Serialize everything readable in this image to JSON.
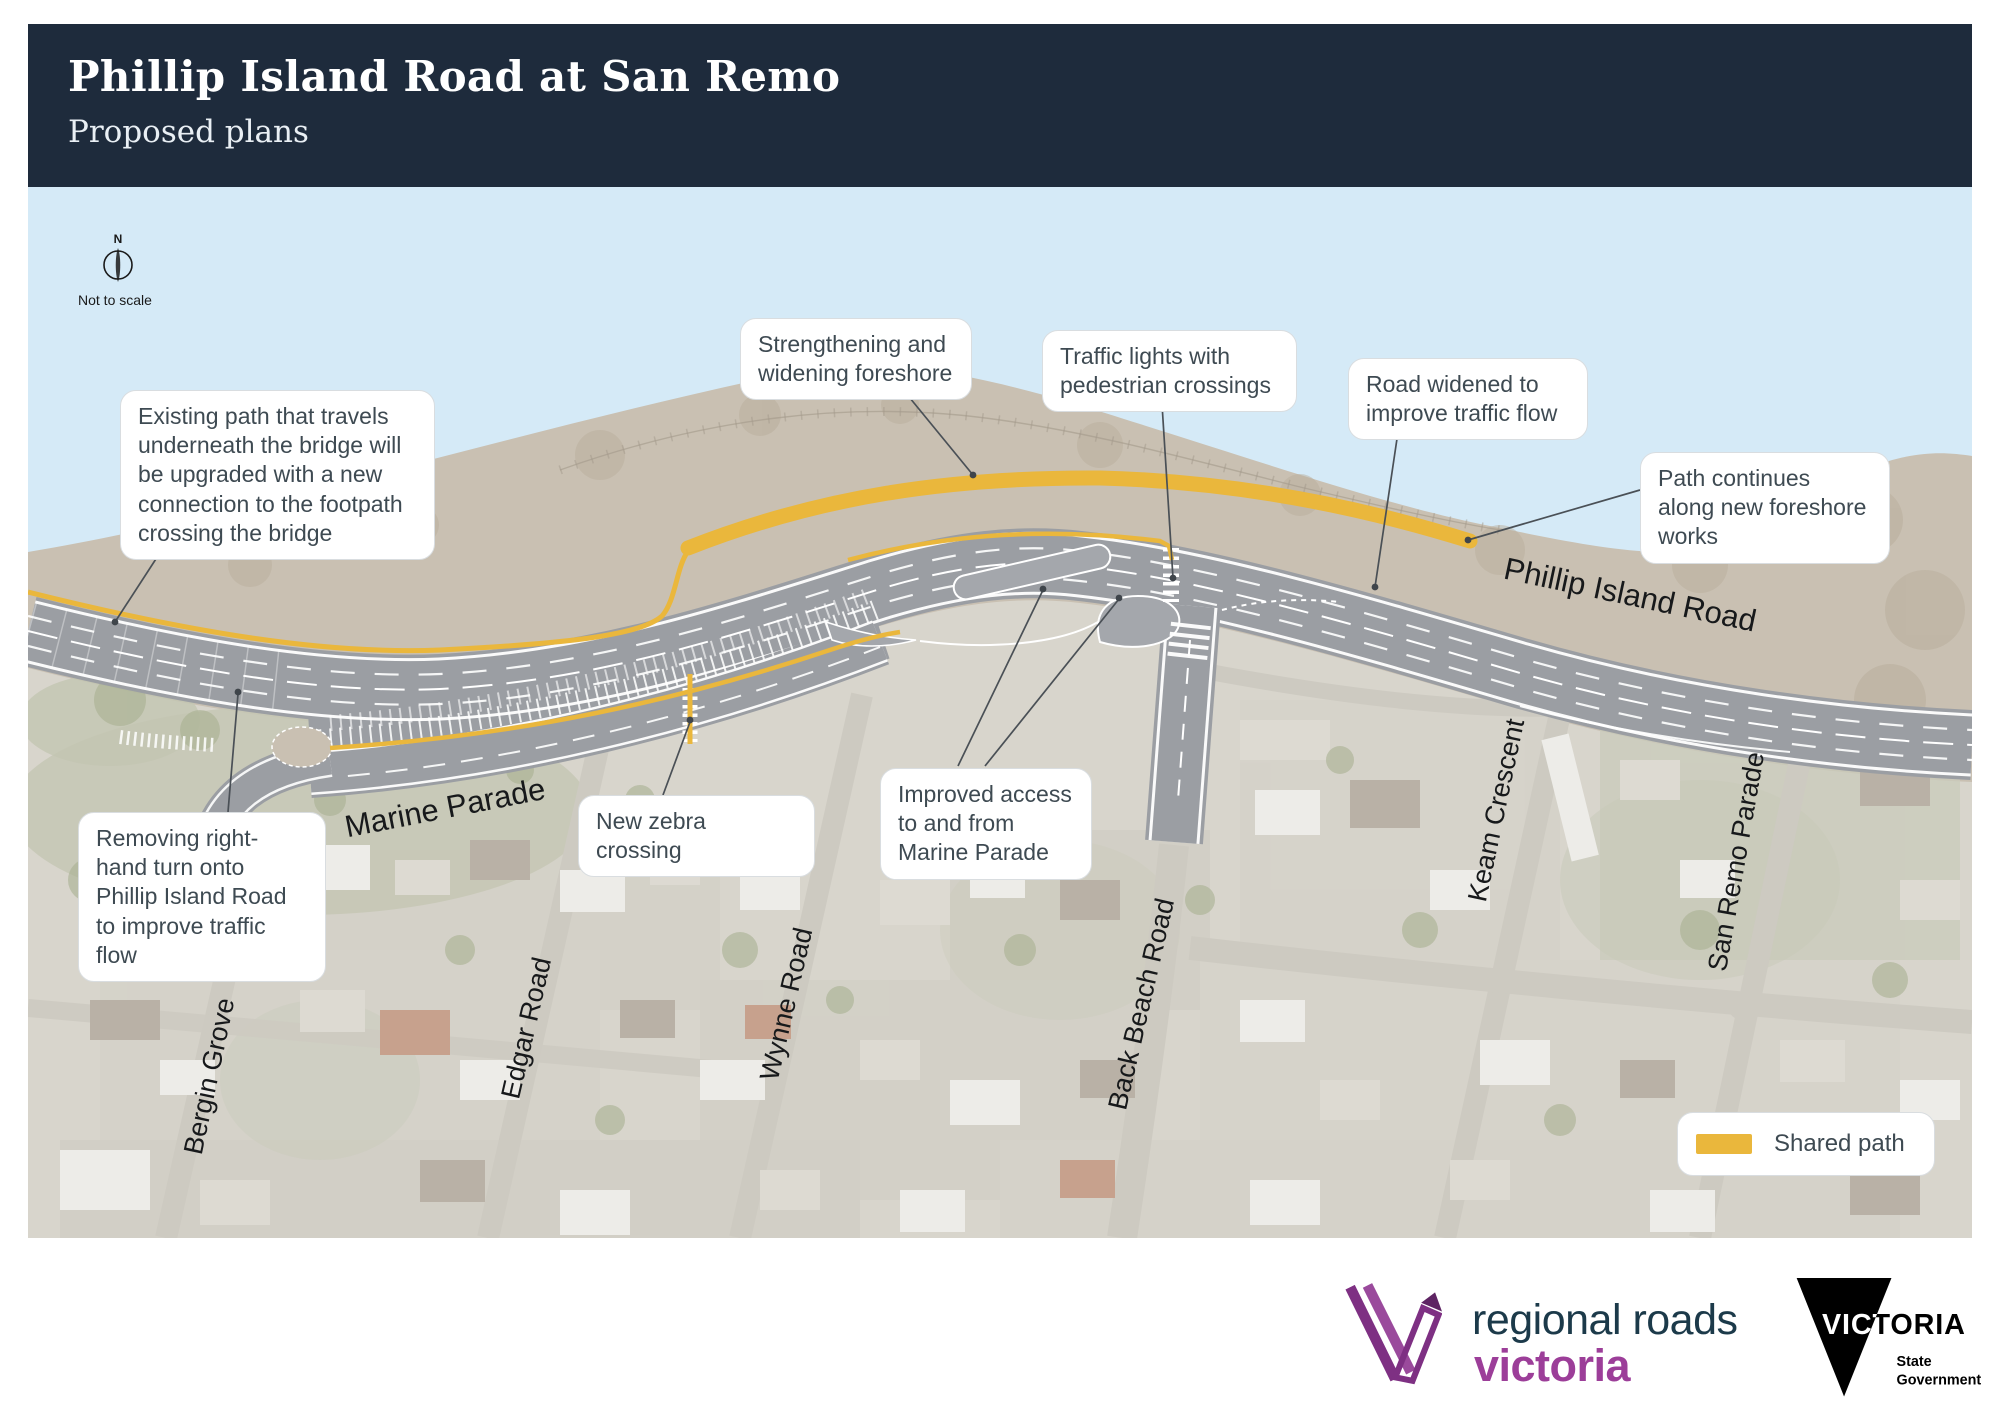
{
  "header": {
    "title": "Phillip Island Road at San Remo",
    "subtitle": "Proposed plans"
  },
  "map": {
    "compass": {
      "north": "N",
      "note": "Not to scale"
    },
    "callouts": [
      {
        "id": "existing-path",
        "text": "Existing path that travels underneath the bridge will be upgraded with a new connection to the footpath crossing the bridge"
      },
      {
        "id": "strengthening",
        "text": "Strengthening and widening foreshore"
      },
      {
        "id": "traffic-lights",
        "text": "Traffic lights with pedestrian crossings"
      },
      {
        "id": "road-widened",
        "text": "Road widened to improve traffic flow"
      },
      {
        "id": "path-continues",
        "text": "Path continues along new foreshore works"
      },
      {
        "id": "new-zebra-crossing",
        "text": "New zebra crossing"
      },
      {
        "id": "improved-access",
        "text": "Improved access to and from Marine Parade"
      },
      {
        "id": "removing-right-turn",
        "text": "Removing right-hand turn onto Phillip Island Road to improve traffic flow"
      }
    ],
    "road_labels": [
      {
        "text": "Phillip Island Road"
      },
      {
        "text": "Marine Parade"
      },
      {
        "text": "Bergin Grove"
      },
      {
        "text": "Edgar Road"
      },
      {
        "text": "Wynne Road"
      },
      {
        "text": "Back Beach Road"
      },
      {
        "text": "Keam Crescent"
      },
      {
        "text": "San Remo Parade"
      }
    ],
    "legend": {
      "label": "Shared path",
      "swatch_color": "#EAB73C"
    },
    "reference_code": "PTVH5189 STU02783 08.20",
    "colors": {
      "water": "#D5EAF7",
      "foreshore": "#C9C0B2",
      "town": "#D8D5CC",
      "road": "#9B9EA3",
      "shared_path": "#EAB73C",
      "header": "#1E2B3C"
    }
  },
  "footer": {
    "rrv": {
      "line1": "regional roads",
      "line2": "victoria"
    },
    "vic": {
      "name": "VICTORIA",
      "sub1": "State",
      "sub2": "Government"
    }
  }
}
